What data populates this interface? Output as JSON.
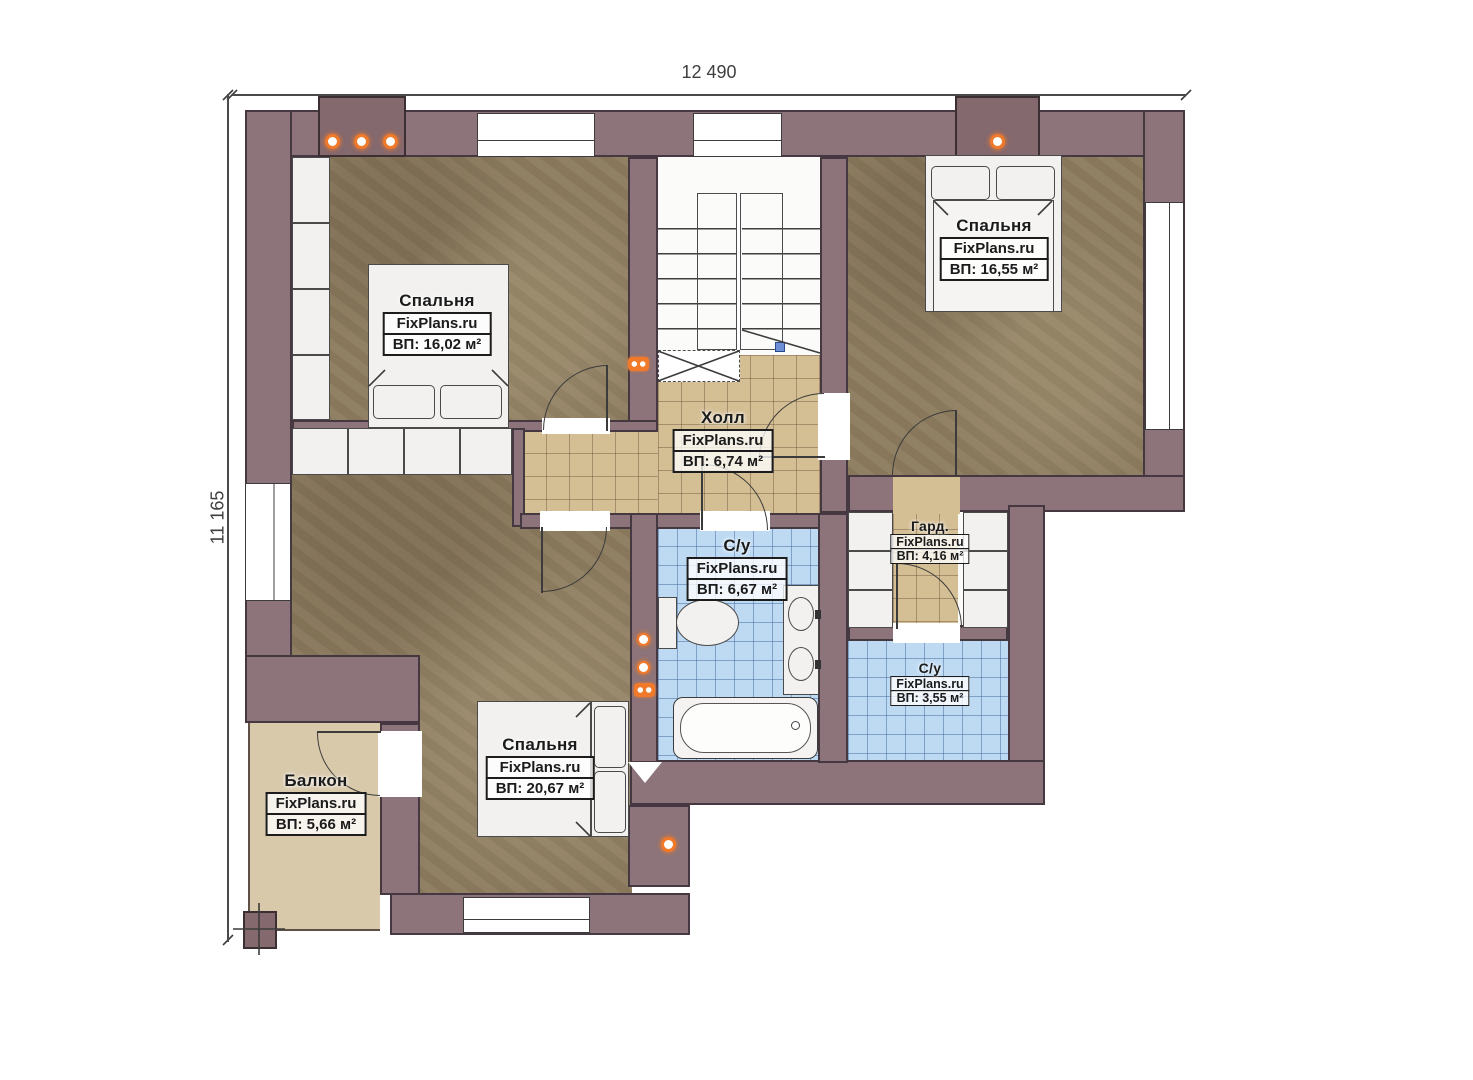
{
  "brand": "FixPlans.ru",
  "dimensions": {
    "width": "12 490",
    "height": "11 165"
  },
  "rooms": [
    {
      "id": "bedroom-top-left",
      "name": "Спальня",
      "brand": "FixPlans.ru",
      "area": "ВП: 16,02 м²"
    },
    {
      "id": "bedroom-top-right",
      "name": "Спальня",
      "brand": "FixPlans.ru",
      "area": "ВП: 16,55 м²"
    },
    {
      "id": "hall",
      "name": "Холл",
      "brand": "FixPlans.ru",
      "area": "ВП: 6,74 м²"
    },
    {
      "id": "bathroom-main",
      "name": "С/у",
      "brand": "FixPlans.ru",
      "area": "ВП: 6,67 м²"
    },
    {
      "id": "wardrobe",
      "name": "Гард.",
      "brand": "FixPlans.ru",
      "area": "ВП: 4,16 м²"
    },
    {
      "id": "bathroom-small",
      "name": "С/у",
      "brand": "FixPlans.ru",
      "area": "ВП: 3,55 м²"
    },
    {
      "id": "bedroom-bottom",
      "name": "Спальня",
      "brand": "FixPlans.ru",
      "area": "ВП: 20,67 м²"
    },
    {
      "id": "balcony",
      "name": "Балкон",
      "brand": "FixPlans.ru",
      "area": "ВП: 5,66 м²"
    }
  ],
  "colors": {
    "wall": "#8c747a",
    "wood_floor": "#8d7c5f",
    "tile_tan": "#d4be94",
    "tile_blue": "#bedaf3",
    "balcony_floor": "#d8c9ab",
    "accent_orange": "#f0792a"
  }
}
